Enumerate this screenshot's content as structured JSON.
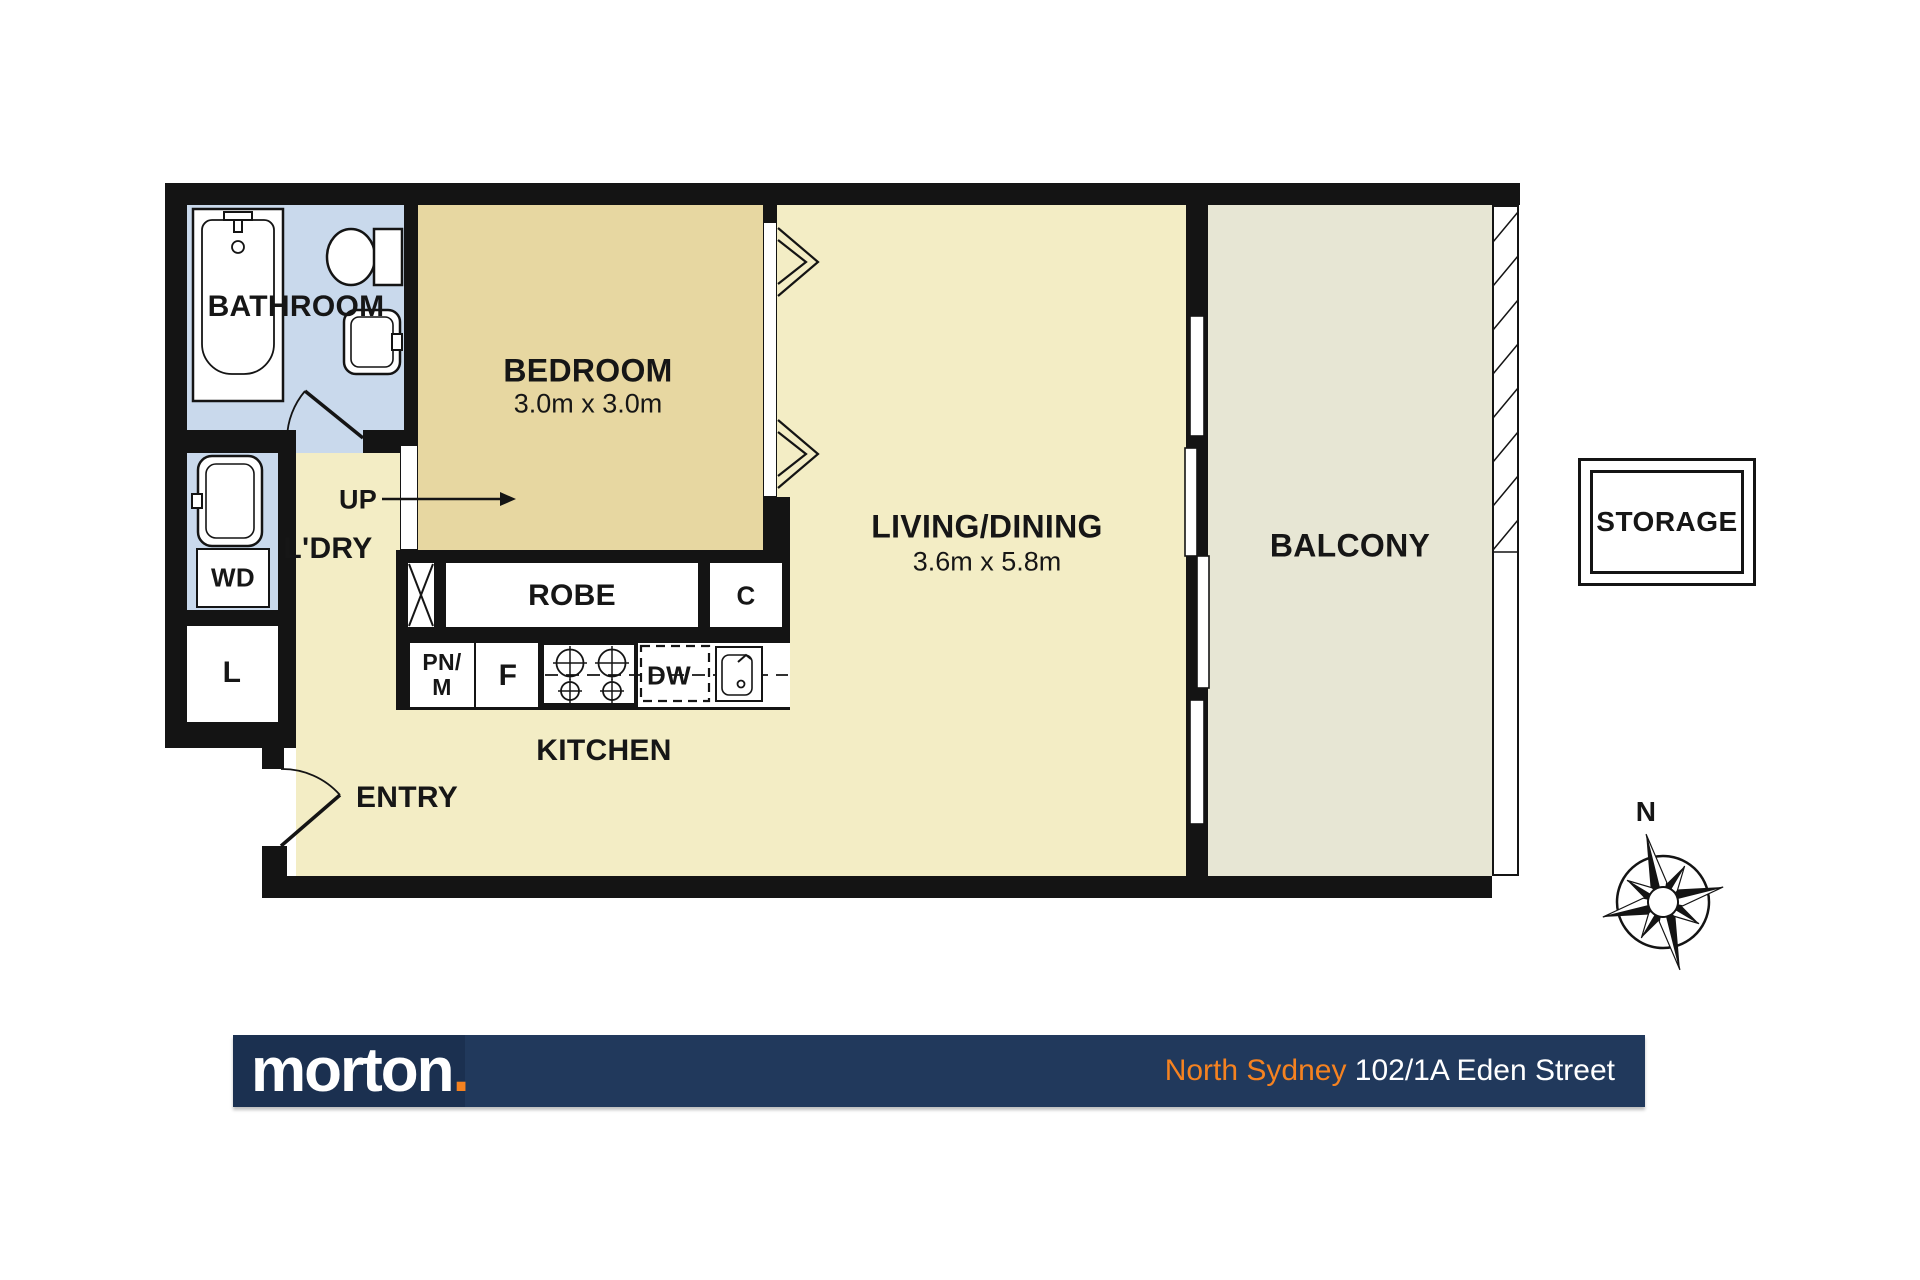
{
  "rooms": {
    "bathroom": {
      "label": "BATHROOM"
    },
    "bedroom": {
      "label": "BEDROOM",
      "dims": "3.0m x 3.0m"
    },
    "living": {
      "label": "LIVING/DINING",
      "dims": "3.6m x 5.8m"
    },
    "balcony": {
      "label": "BALCONY"
    },
    "kitchen": {
      "label": "KITCHEN"
    },
    "entry": {
      "label": "ENTRY"
    },
    "laundry": {
      "label": "L'DRY"
    },
    "robe": {
      "label": "ROBE"
    },
    "storage": {
      "label": "STORAGE"
    }
  },
  "markers": {
    "up": "UP",
    "washer_dryer": "WD",
    "linen": "L",
    "cupboard": "C",
    "pantry_micro": "PN/\nM",
    "fridge": "F",
    "dishwasher": "DW",
    "north": "N"
  },
  "footer": {
    "brand": "morton",
    "brand_dot": ".",
    "suburb": "North Sydney",
    "street": "102/1A Eden Street"
  },
  "colors": {
    "wall": "#141414",
    "wet": "#c9d9ec",
    "bedroom": "#e7d7a1",
    "living": "#f3edc5",
    "balcony": "#e7e6d4",
    "navy": "#21395c",
    "navy_dark": "#1b3050",
    "orange": "#f58220"
  }
}
